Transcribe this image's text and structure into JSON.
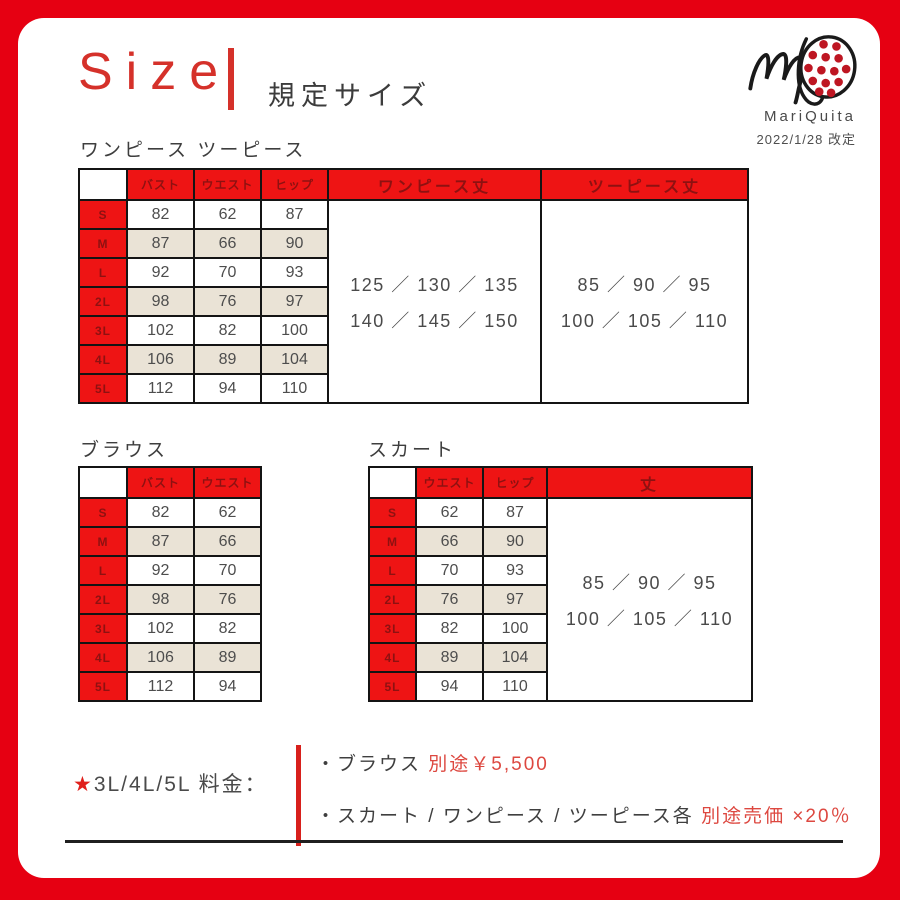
{
  "page": {
    "title_en": "Size",
    "title_ja": "規定サイズ",
    "brand": "MariQuita",
    "revision": "2022/1/28 改定"
  },
  "colors": {
    "frame_red": "#e60012",
    "cell_red": "#ee1414",
    "header_text_red": "#8e1111",
    "row_beige": "#eae3d6",
    "accent_text_red": "#dd4840"
  },
  "sections": {
    "onepiece": {
      "title": "ワンピース ツーピース",
      "col_headers": [
        "バスト",
        "ウエスト",
        "ヒップ"
      ],
      "merged_headers": [
        "ワンピース丈",
        "ツーピース丈"
      ],
      "sizes": [
        "S",
        "M",
        "L",
        "2L",
        "3L",
        "4L",
        "5L"
      ],
      "rows": [
        [
          82,
          62,
          87
        ],
        [
          87,
          66,
          90
        ],
        [
          92,
          70,
          93
        ],
        [
          98,
          76,
          97
        ],
        [
          102,
          82,
          100
        ],
        [
          106,
          89,
          104
        ],
        [
          112,
          94,
          110
        ]
      ],
      "merged": [
        {
          "name": "onepiece-length-cell",
          "lines": [
            "125 ／ 130 ／ 135",
            "140 ／ 145 ／ 150"
          ]
        },
        {
          "name": "twopiece-length-cell",
          "lines": [
            "85 ／ 90 ／ 95",
            "100 ／ 105 ／ 110"
          ]
        }
      ]
    },
    "blouse": {
      "title": "ブラウス",
      "col_headers": [
        "バスト",
        "ウエスト"
      ],
      "sizes": [
        "S",
        "M",
        "L",
        "2L",
        "3L",
        "4L",
        "5L"
      ],
      "rows": [
        [
          82,
          62
        ],
        [
          87,
          66
        ],
        [
          92,
          70
        ],
        [
          98,
          76
        ],
        [
          102,
          82
        ],
        [
          106,
          89
        ],
        [
          112,
          94
        ]
      ]
    },
    "skirt": {
      "title": "スカート",
      "col_headers": [
        "ウエスト",
        "ヒップ"
      ],
      "merged_headers": [
        "丈"
      ],
      "sizes": [
        "S",
        "M",
        "L",
        "2L",
        "3L",
        "4L",
        "5L"
      ],
      "rows": [
        [
          62,
          87
        ],
        [
          66,
          90
        ],
        [
          70,
          93
        ],
        [
          76,
          97
        ],
        [
          82,
          100
        ],
        [
          89,
          104
        ],
        [
          94,
          110
        ]
      ],
      "merged": [
        {
          "name": "skirt-length-cell",
          "lines": [
            "85 ／ 90 ／ 95",
            "100 ／ 105 ／ 110"
          ]
        }
      ]
    },
    "fees": {
      "star": "★",
      "label": "3L/4L/5L 料金：",
      "items": [
        {
          "plain": "・ブラウス ",
          "red": "別途￥5,500"
        },
        {
          "plain": "・スカート / ワンピース / ツーピース各 ",
          "red": "別途売価 ×20％"
        }
      ]
    }
  }
}
